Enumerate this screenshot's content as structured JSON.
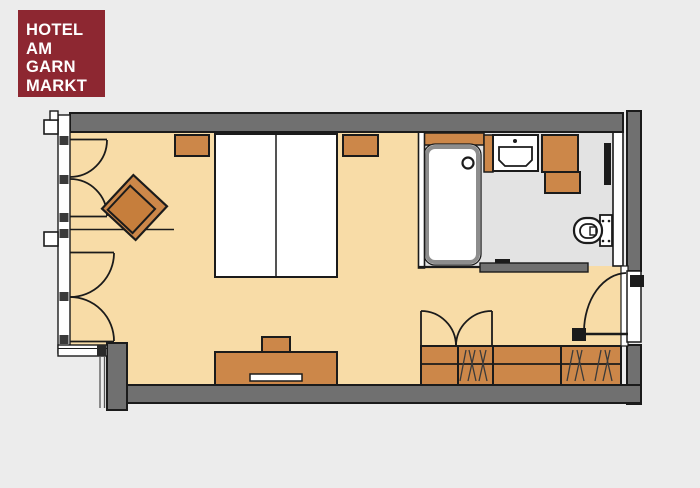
{
  "logo": {
    "lines": [
      "HOTEL",
      "AM",
      "GARN",
      "MARKT"
    ]
  },
  "palette": {
    "page_bg": "#ececec",
    "logo_bg": "#8d2731",
    "logo_text": "#ffffff",
    "floor": "#f8dca7",
    "bath_floor": "#e3e3e3",
    "wall": "#707070",
    "furniture": "#cc8749",
    "seat": "#c67e3c",
    "fixture_white": "#ffffff",
    "tub_border": "#8d8d8d",
    "outline": "#1b1b1b"
  },
  "plan": {
    "rooms": [
      {
        "name": "bedroom"
      },
      {
        "name": "bathroom"
      }
    ],
    "furniture": [
      "double-bed",
      "nightstand-left",
      "nightstand-right",
      "armchair",
      "sideboard-with-tv",
      "wardrobe",
      "bathtub",
      "washbasin",
      "vanity-cabinet",
      "wall-toilet",
      "towel-radiator"
    ],
    "openings": [
      "french-window-upper",
      "french-window-lower",
      "bathroom-sliding-door",
      "wardrobe-double-doors",
      "entry-door"
    ]
  }
}
